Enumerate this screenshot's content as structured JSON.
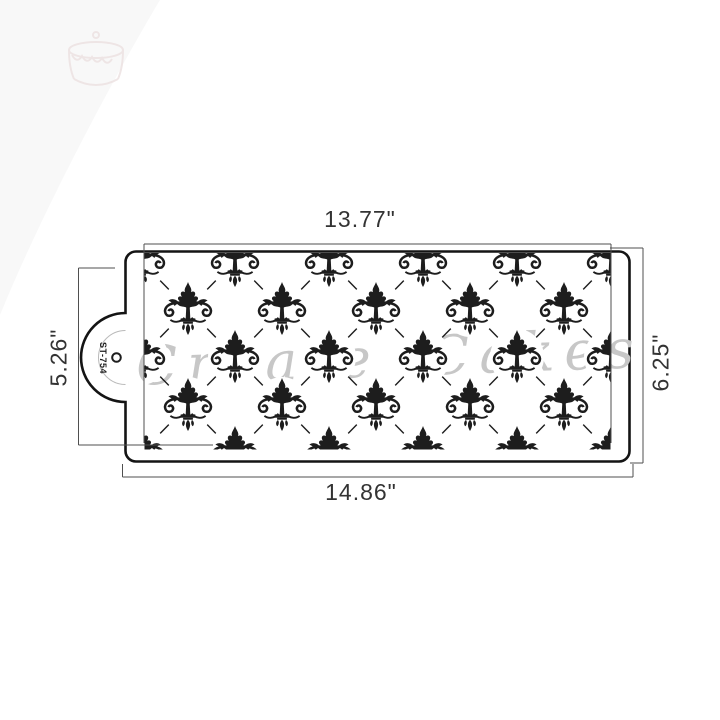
{
  "stencil": {
    "tab_label": "ST-754",
    "watermark": "Create Cakes",
    "pattern_name": "fleur-de-lis-damask-trellis",
    "colors": {
      "ink": "#1d1d1d",
      "outline": "#141414",
      "dim": "#4f4f4f",
      "dimtext": "#333333",
      "watermark": "#c7c7c7"
    },
    "pattern": {
      "rows_y": [
        261,
        309,
        357,
        405,
        453
      ],
      "cols_even_x": [
        141,
        235,
        329,
        423,
        517,
        611
      ],
      "cols_odd_x": [
        188,
        282,
        376,
        470,
        564
      ],
      "dx": 47
    }
  },
  "dimensions": {
    "top": {
      "label": "13.77\""
    },
    "bottom": {
      "label": "14.86\""
    },
    "left": {
      "label": "5.26\""
    },
    "right": {
      "label": "6.25\""
    }
  }
}
